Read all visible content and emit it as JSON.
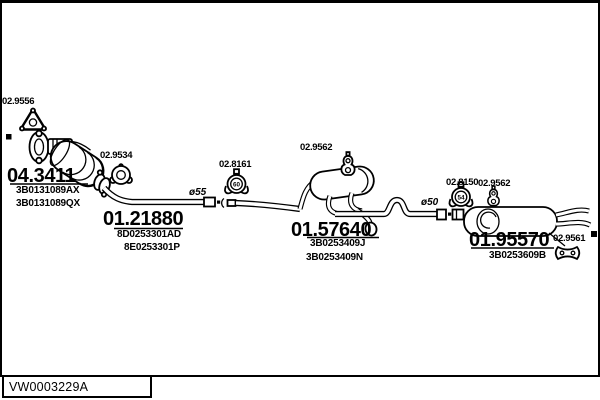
{
  "diagram": {
    "footer_code": "VW0003229A",
    "pipe_diameters": {
      "front": "ø55",
      "rear": "ø50"
    }
  },
  "assemblies": {
    "catalyst": {
      "code": "04.3411",
      "oe": [
        "3B0131089AX",
        "3B0131089QX"
      ]
    },
    "front_pipe": {
      "code": "01.21880",
      "oe": [
        "8D0253301AD",
        "8E0253301P"
      ]
    },
    "centre_muffler": {
      "code": "01.57640",
      "oe": [
        "3B0253409J",
        "3B0253409N"
      ]
    },
    "rear_muffler": {
      "code": "01.95570",
      "oe": [
        "3B0253609B"
      ]
    }
  },
  "fittings": {
    "gasket_triangle": {
      "code": "02.9556"
    },
    "gasket_ring": {
      "code": "02.9534"
    },
    "clamp_front": {
      "code": "02.8161",
      "size": "60"
    },
    "hanger_centre": {
      "code": "02.9562"
    },
    "clamp_rear": {
      "code": "02.8150",
      "size": "54"
    },
    "hanger_rear": {
      "code": "02.9562"
    },
    "hanger_tail": {
      "code": "02.9561"
    }
  }
}
